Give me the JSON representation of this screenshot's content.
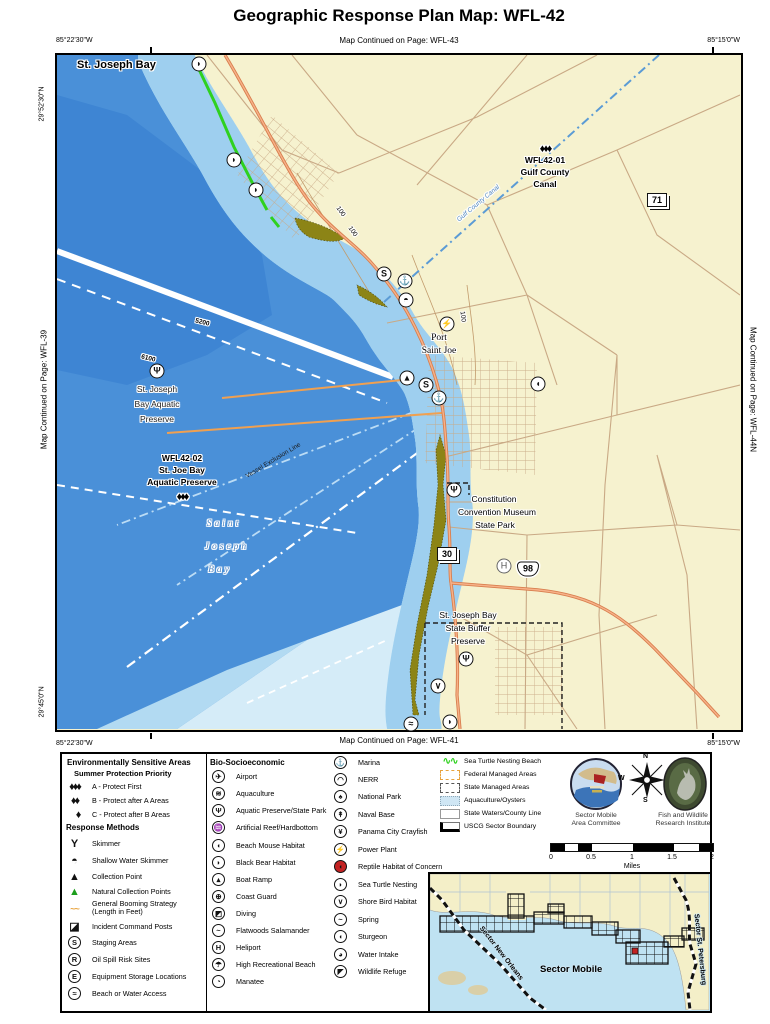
{
  "colors": {
    "land": "#F6F2CF",
    "water": "#4A90D8",
    "water_deep": "#3E85D3",
    "shallow1": "#9ECFEF",
    "shallow2": "#C7E7F8",
    "shallow3": "#E3F5FC",
    "road_orange": "#D87E4E",
    "road_tan": "#C9A985",
    "nesting_green": "#2FD11F",
    "marsh_olive": "#8C8416",
    "inset_water": "#BFE2F2",
    "priority_red": "#C32222"
  },
  "header": {
    "title": "Geographic Response Plan Map: WFL-42"
  },
  "edge": {
    "top_text": "Map Continued on Page: WFL-43",
    "bottom_text": "Map Continued on Page: WFL-41",
    "left_text": "Map Continued on Page: WFL-39",
    "right_text": "Map Continued on Page: WFL-44N",
    "lon_left": "85°22'30\"W",
    "lon_right": "85°15'0\"W",
    "lat_top": "29°52'30\"N",
    "lat_bottom": "29°45'0\"N"
  },
  "map": {
    "bay_label": "St. Joseph Bay",
    "site1": {
      "diamonds": "♦♦♦",
      "id": "WFL42-01",
      "l1": "Gulf County",
      "l2": "Canal"
    },
    "site2": {
      "id": "WFL42-02",
      "l1": "St. Joe Bay",
      "l2": "Aquatic Preserve",
      "diamonds": "♦♦♦"
    },
    "aquatic_preserve": {
      "l1": "St. Joseph",
      "l2": "Bay Aquatic",
      "l3": "Preserve"
    },
    "bay_italic": {
      "l1": "Saint",
      "l2": "Joseph",
      "l3": "Bay"
    },
    "port": {
      "l1": "Port",
      "l2": "Saint Joe"
    },
    "museum": {
      "l1": "Constitution",
      "l2": "Convention Museum",
      "l3": "State Park"
    },
    "buffer": {
      "l1": "St. Joseph Bay",
      "l2": "State Buffer",
      "l3": "Preserve"
    },
    "canal_label": "Gulf County Canal",
    "vessel_line": "Vessel Exclusion Line",
    "shield71": "71",
    "shield30": "30",
    "shield98": "98",
    "depth1": "100",
    "depth2": "100",
    "depth3": "100",
    "boom1": "5200",
    "boom2": "6100",
    "icons": {
      "turtle": "◗",
      "staging": "S",
      "marina": "⚓",
      "boatramp": "▴",
      "skimmer": "◓",
      "power": "⚡",
      "bear": "◖",
      "statepark": "Ψ",
      "heliport": "H",
      "beach": "≈",
      "shorebird": "∨"
    }
  },
  "legend": {
    "esa_header": "Environmentally Sensitive Areas",
    "priority_header": "Summer Protection Priority",
    "priority": [
      {
        "d": "♦♦♦",
        "label": "A - Protect First"
      },
      {
        "d": "♦♦",
        "label": "B - Protect after A Areas"
      },
      {
        "d": "♦",
        "label": "C - Protect after B Areas"
      }
    ],
    "response_header": "Response Methods",
    "response": [
      {
        "glyph": "Y",
        "label": "Skimmer"
      },
      {
        "glyph": "◓",
        "label": "Shallow Water Skimmer"
      },
      {
        "glyph": "▲",
        "label": "Collection Point"
      },
      {
        "glyph": "▲",
        "label": "Natural Collection Points"
      },
      {
        "glyph": "~~",
        "label": "General Booming Strategy",
        "label2": "(Length in Feet)"
      },
      {
        "glyph": "◪",
        "label": "Incident Command Posts"
      },
      {
        "glyph": "S",
        "label": "Staging Areas"
      },
      {
        "glyph": "R",
        "label": "Oil Spill Risk Sites"
      },
      {
        "glyph": "E",
        "label": "Equipment Storage Locations"
      },
      {
        "glyph": "≈",
        "label": "Beach or Water Access"
      }
    ],
    "bio_header": "Bio-Socioeconomic",
    "bio": [
      {
        "glyph": "✈",
        "label": "Airport"
      },
      {
        "glyph": "≋",
        "label": "Aquaculture"
      },
      {
        "glyph": "Ψ",
        "label": "Aquatic Preserve/State Park"
      },
      {
        "glyph": "♒",
        "label": "Artificial Reef/Hardbottom"
      },
      {
        "glyph": "◖",
        "label": "Beach Mouse Habitat"
      },
      {
        "glyph": "◗",
        "label": "Black Bear Habitat"
      },
      {
        "glyph": "▴",
        "label": "Boat Ramp"
      },
      {
        "glyph": "⊕",
        "label": "Coast Guard"
      },
      {
        "glyph": "◩",
        "label": "Diving"
      },
      {
        "glyph": "~",
        "label": "Flatwoods Salamander"
      },
      {
        "glyph": "H",
        "label": "Heliport"
      },
      {
        "glyph": "☂",
        "label": "High Recreational Beach"
      },
      {
        "glyph": "◔",
        "label": "Manatee"
      }
    ],
    "bio2": [
      {
        "glyph": "⚓",
        "label": "Marina"
      },
      {
        "glyph": "◠",
        "label": "NERR"
      },
      {
        "glyph": "♠",
        "label": "National Park"
      },
      {
        "glyph": "↟",
        "label": "Naval Base"
      },
      {
        "glyph": "¥",
        "label": "Panama City Crayfish"
      },
      {
        "glyph": "⚡",
        "label": "Power Plant"
      },
      {
        "glyph": "◖",
        "label": "Reptile Habitat of Concern"
      },
      {
        "glyph": "◗",
        "label": "Sea Turtle Nesting"
      },
      {
        "glyph": "∨",
        "label": "Shore Bird Habitat"
      },
      {
        "glyph": "~",
        "label": "Spring"
      },
      {
        "glyph": "◖",
        "label": "Sturgeon"
      },
      {
        "glyph": "◕",
        "label": "Water Intake"
      },
      {
        "glyph": "◤",
        "label": "Wildlife Refuge"
      }
    ],
    "areas": [
      {
        "glyph": "∿∿",
        "label": "Sea Turtle Nesting Beach"
      },
      {
        "label": "Federal Managed Areas"
      },
      {
        "label": "State Managed Areas"
      },
      {
        "label": "Aquaculture/Oysters"
      },
      {
        "label": "State Waters/County Line"
      },
      {
        "label": "USCG Sector Boundary"
      }
    ],
    "footer": {
      "logo1_l1": "Sector Mobile",
      "logo1_l2": "Area Committee",
      "logo2_l1": "Fish and Wildlife",
      "logo2_l2": "Research Institute",
      "compass": {
        "n": "N",
        "s": "S",
        "e": "E",
        "w": "W"
      }
    },
    "scale": {
      "t0": "0",
      "t1": "0.5",
      "t2": "1",
      "t3": "1.5",
      "t4": "2",
      "unit": "Miles"
    },
    "inset": {
      "title": "Sector Mobile",
      "left": "Sector New Orleans",
      "right": "Sector St. Petersburg"
    }
  }
}
